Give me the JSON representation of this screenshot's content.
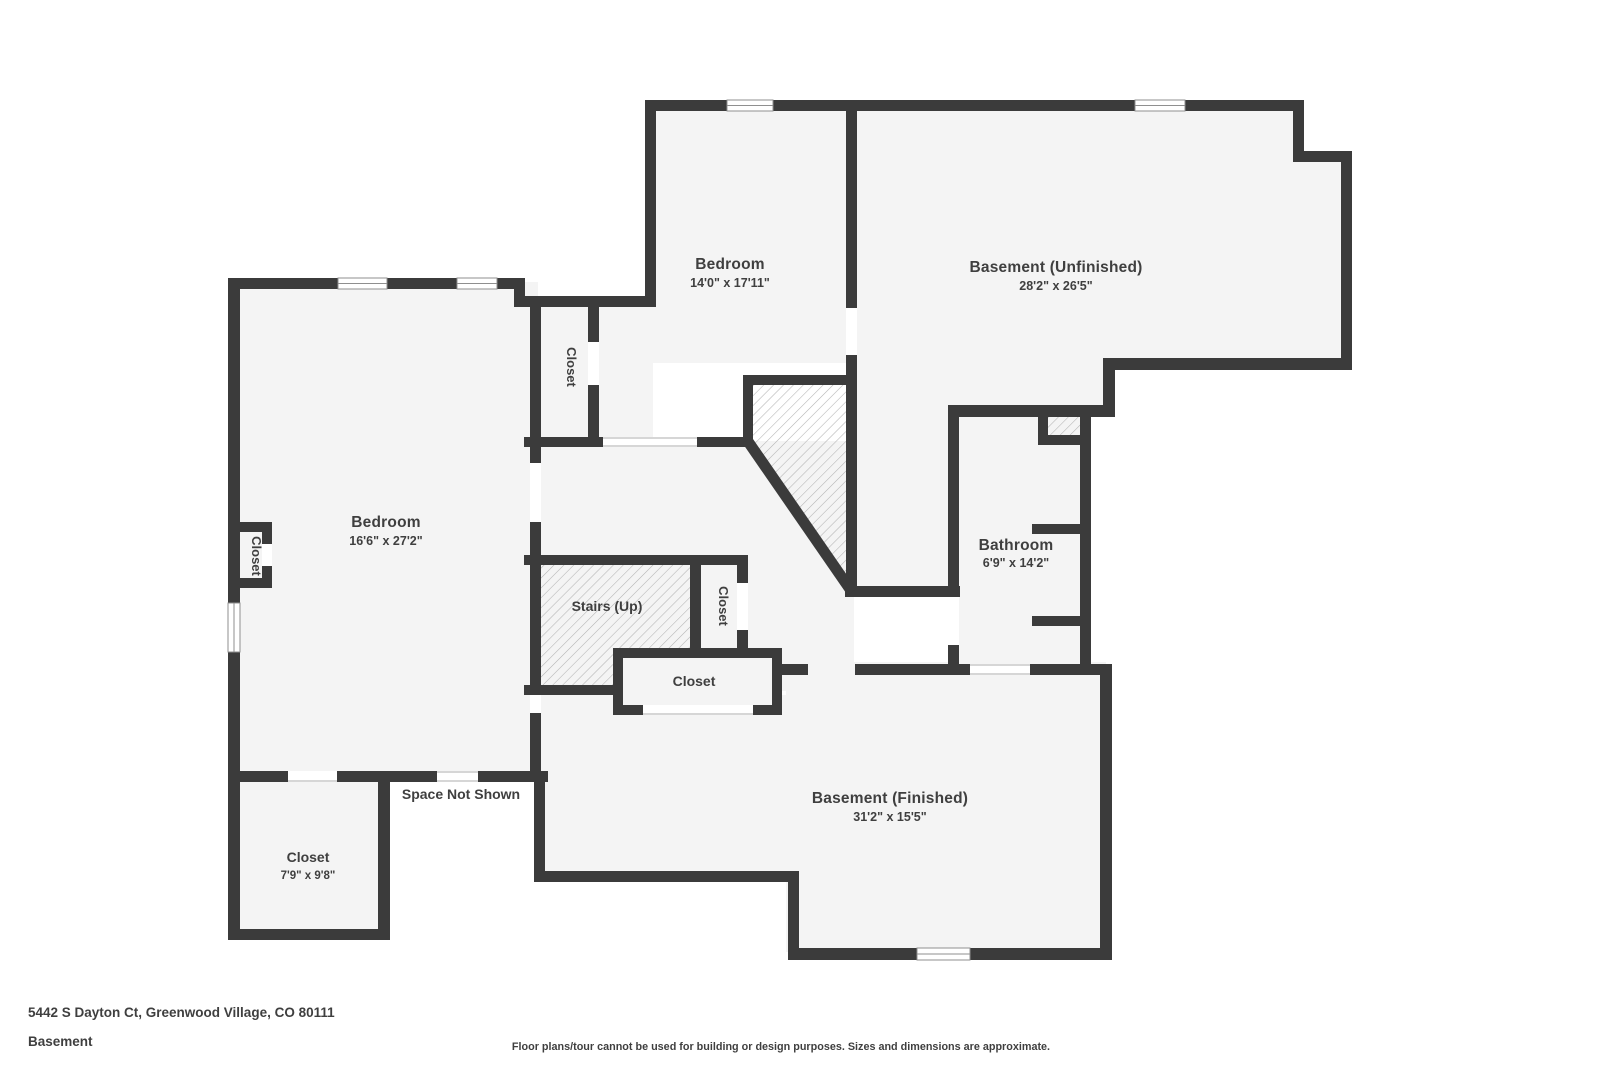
{
  "plan": {
    "rooms": {
      "bedroom_top": {
        "name": "Bedroom",
        "dims": "14'0\" x 17'11\""
      },
      "basement_unfinished": {
        "name": "Basement (Unfinished)",
        "dims": "28'2\" x 26'5\""
      },
      "bedroom_left": {
        "name": "Bedroom",
        "dims": "16'6\" x 27'2\""
      },
      "bathroom": {
        "name": "Bathroom",
        "dims": "6'9\" x 14'2\""
      },
      "basement_finished": {
        "name": "Basement (Finished)",
        "dims": "31'2\" x 15'5\""
      },
      "closet_bottom_left": {
        "name": "Closet",
        "dims": "7'9\" x 9'8\""
      },
      "stairs": {
        "name": "Stairs (Up)"
      },
      "closet_bedroom_top": {
        "name": "Closet"
      },
      "closet_hall": {
        "name": "Closet"
      },
      "closet_nook": {
        "name": "Closet"
      },
      "closet_hall_bottom": {
        "name": "Closet"
      },
      "space_not_shown": {
        "name": "Space Not Shown"
      }
    },
    "colors": {
      "wall": "#3b3b3b",
      "floor": "#f4f4f4",
      "hatch": "#b3b3b3",
      "text": "#3f3f3f",
      "background": "#ffffff"
    }
  },
  "footer": {
    "address": "5442 S Dayton Ct, Greenwood Village, CO 80111",
    "level": "Basement",
    "disclaimer": "Floor plans/tour cannot be used for building or design purposes. Sizes and dimensions are approximate."
  }
}
